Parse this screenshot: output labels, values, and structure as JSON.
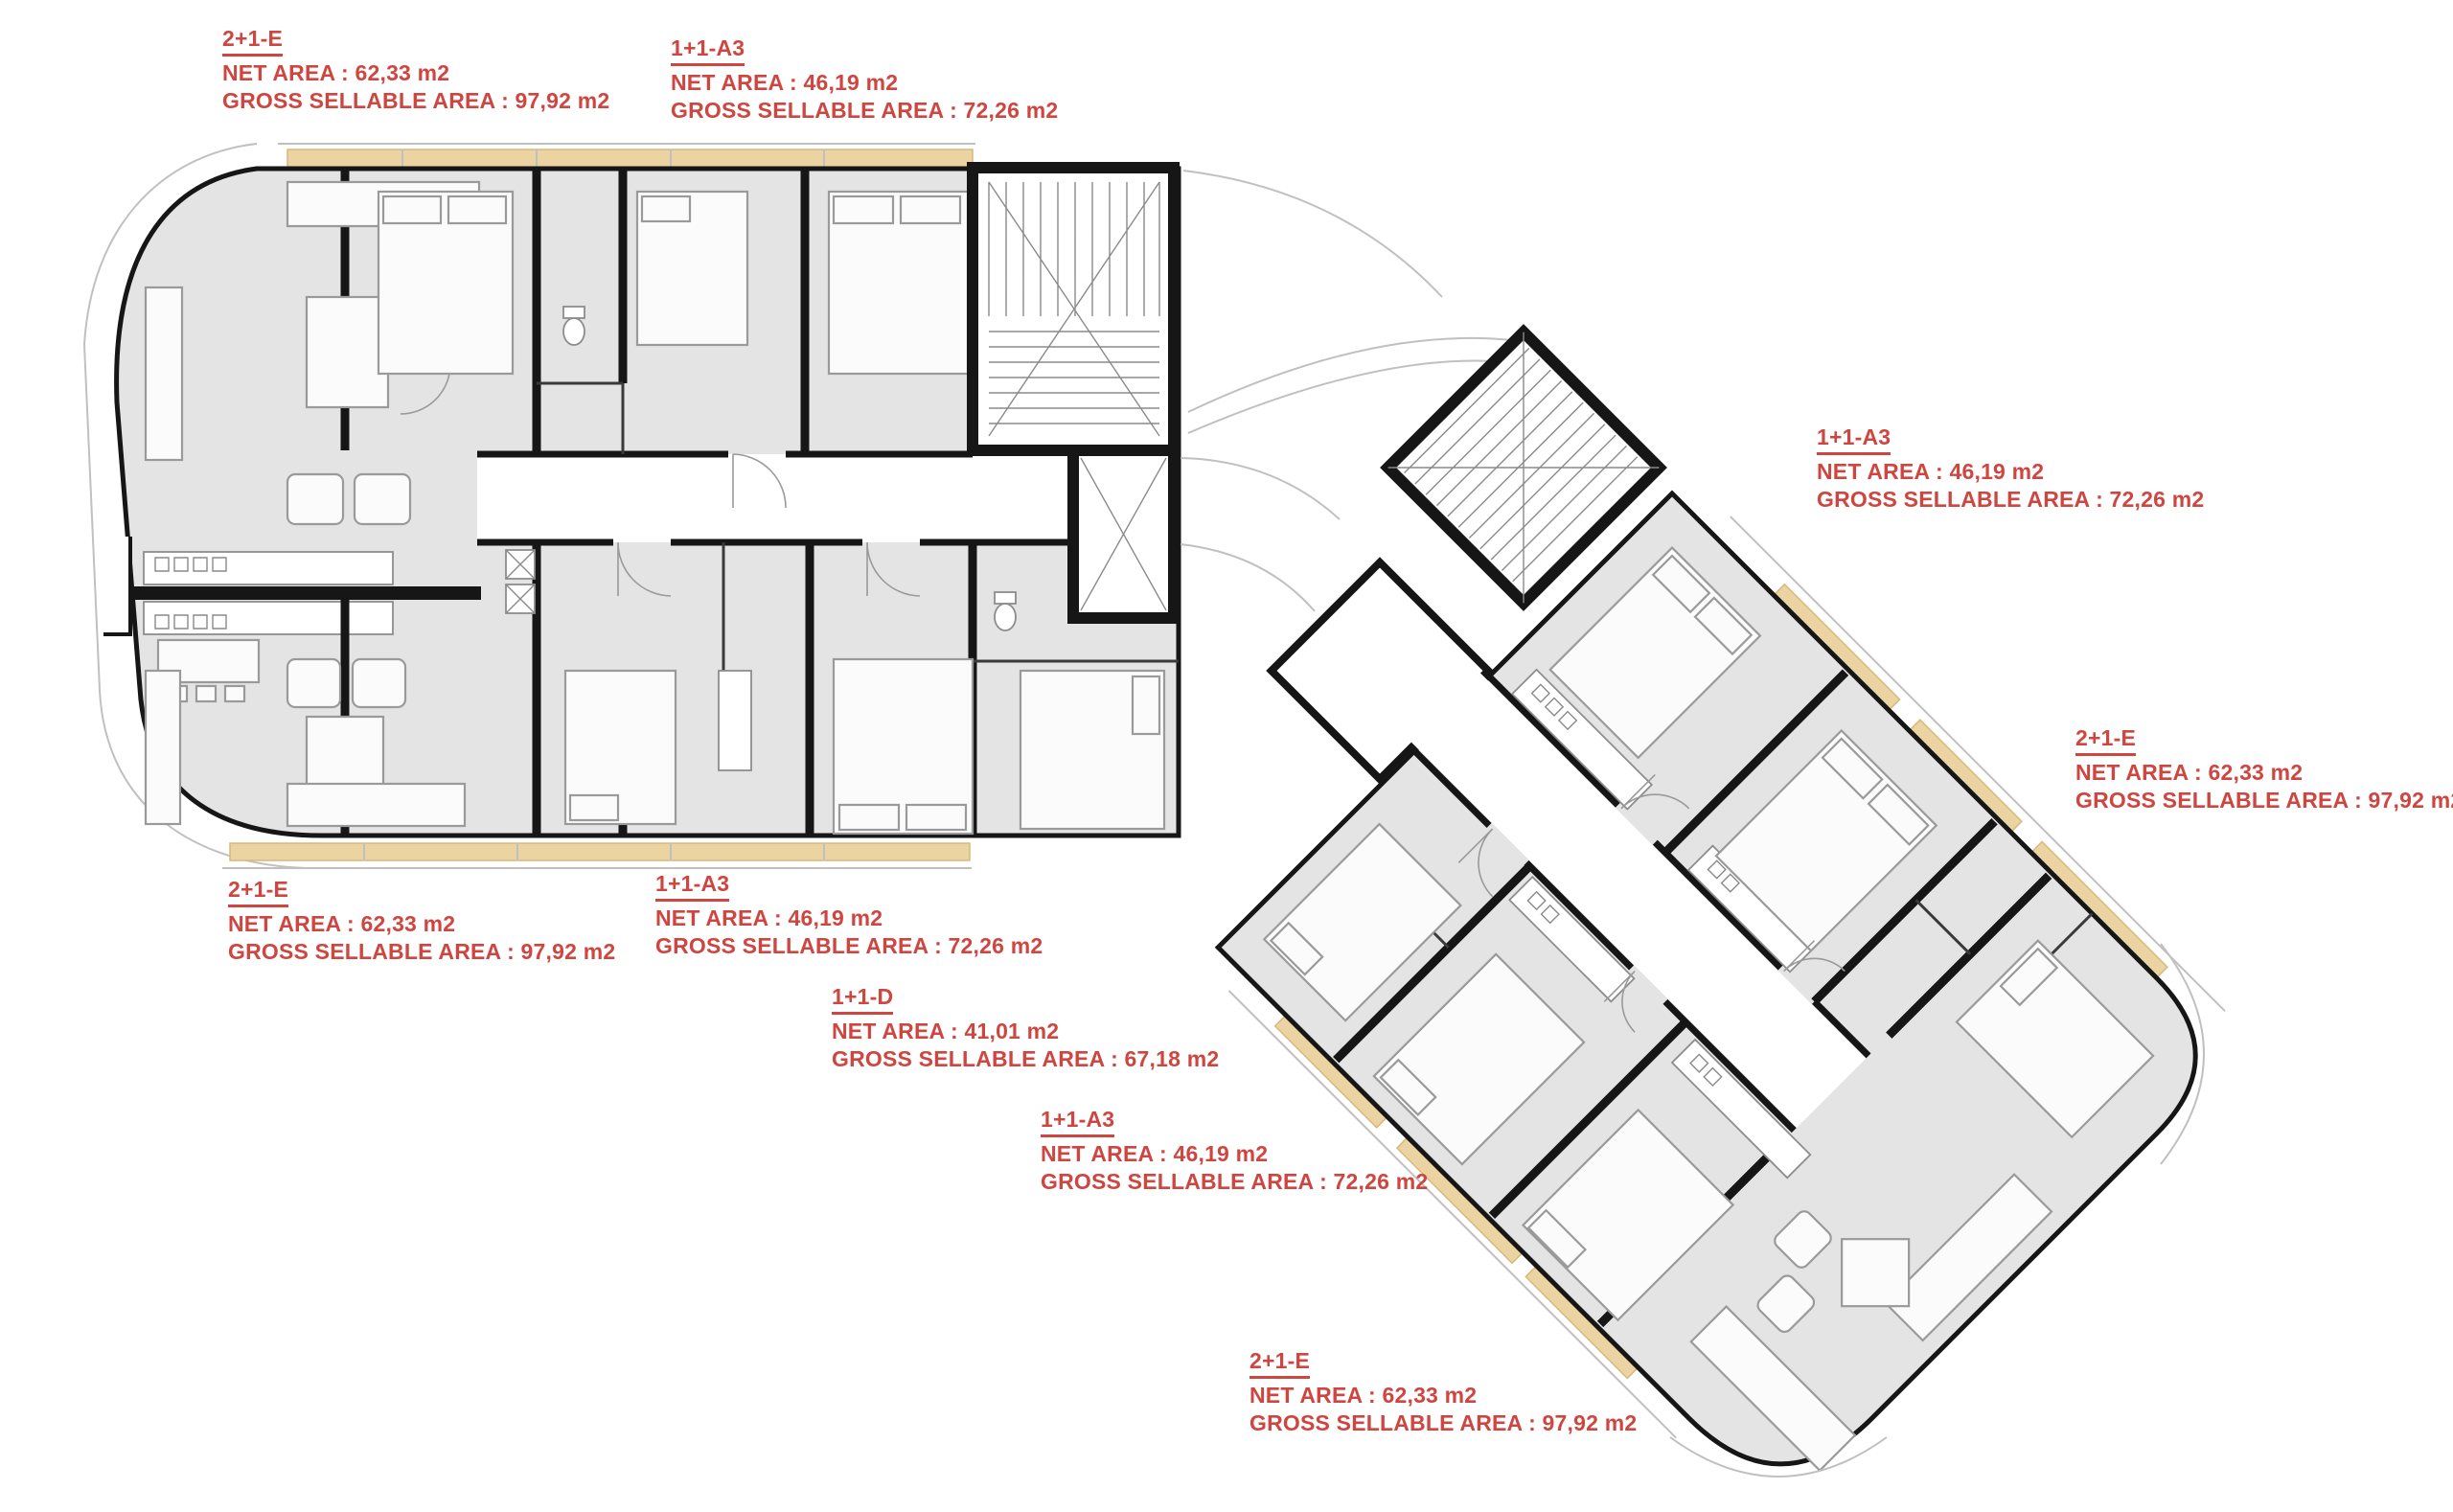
{
  "document": {
    "kind": "apartment floor plan",
    "background": "#ffffff"
  },
  "colors": {
    "label_red": "#cf4540",
    "wall_black": "#161616",
    "floor_gray": "#e4e4e4",
    "balcony_tan": "#ecd3a2",
    "furniture_line_gray": "#9a9a9a"
  },
  "units": [
    {
      "id": "top-left",
      "title": "2+1-E",
      "net_area": "NET AREA : 62,33 m2",
      "gross_area": "GROSS SELLABLE AREA : 97,92 m2"
    },
    {
      "id": "top-center",
      "title": "1+1-A3",
      "net_area": "NET AREA : 46,19 m2",
      "gross_area": "GROSS SELLABLE AREA : 72,26 m2"
    },
    {
      "id": "right-upper",
      "title": "1+1-A3",
      "net_area": "NET AREA : 46,19 m2",
      "gross_area": "GROSS SELLABLE AREA : 72,26 m2"
    },
    {
      "id": "right-mid",
      "title": "2+1-E",
      "net_area": "NET AREA : 62,33 m2",
      "gross_area": "GROSS SELLABLE AREA : 97,92 m2"
    },
    {
      "id": "left-bottom",
      "title": "2+1-E",
      "net_area": "NET AREA : 62,33 m2",
      "gross_area": "GROSS SELLABLE AREA : 97,92 m2"
    },
    {
      "id": "bottom-center",
      "title": "1+1-A3",
      "net_area": "NET AREA : 46,19 m2",
      "gross_area": "GROSS SELLABLE AREA : 72,26 m2"
    },
    {
      "id": "center-d",
      "title": "1+1-D",
      "net_area": "NET AREA : 41,01 m2",
      "gross_area": "GROSS SELLABLE AREA : 67,18 m2"
    },
    {
      "id": "center-a3",
      "title": "1+1-A3",
      "net_area": "NET AREA : 46,19 m2",
      "gross_area": "GROSS SELLABLE AREA : 72,26 m2"
    },
    {
      "id": "bottom-right",
      "title": "2+1-E",
      "net_area": "NET AREA : 62,33 m2",
      "gross_area": "GROSS SELLABLE AREA : 97,92 m2"
    }
  ]
}
